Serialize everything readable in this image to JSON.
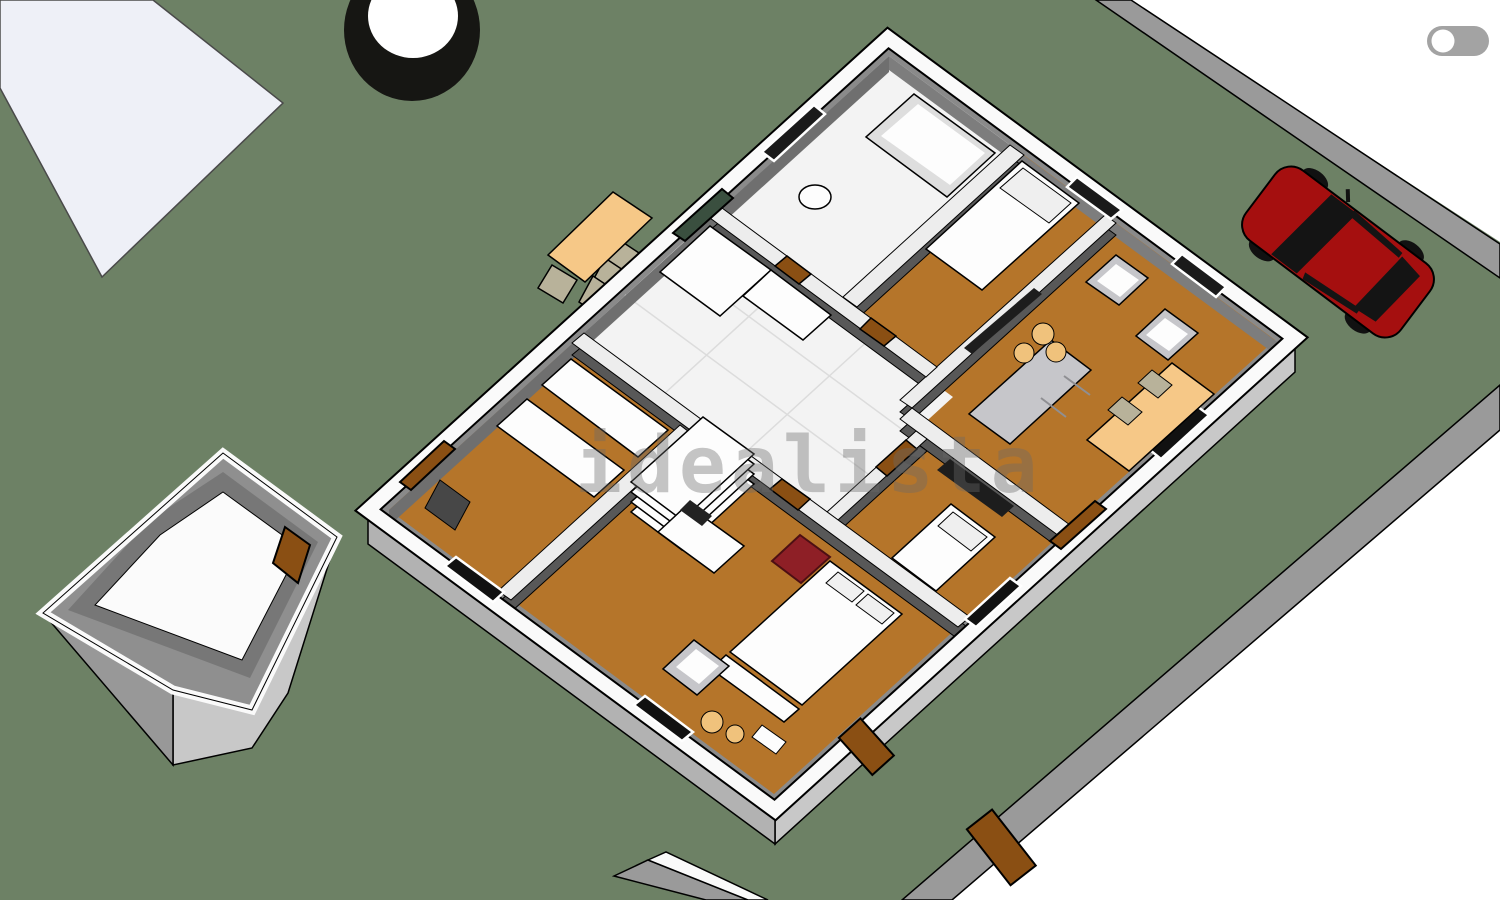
{
  "watermark": {
    "text": "idealista"
  },
  "toggle": {
    "state": "off",
    "label": "view-toggle"
  },
  "colors": {
    "grass": "#6d8165",
    "outside_white": "#ffffff",
    "patio_white": "#eef0f7",
    "perimeter_wall": "#9a9a9a",
    "ext_wall_top": "#fafafa",
    "ext_face_se": "#c8c8c8",
    "ext_face_sw": "#b2b2b2",
    "house_base": "#8a8a8a",
    "inner_face_nw": "#6f6f6f",
    "inner_face_ne": "#7d7d7d",
    "int_wall_top": "#ededed",
    "int_wall_face": "#585858",
    "wood_floor": "#b5752a",
    "tile_floor": "#f3f3f3",
    "tile_line": "#dcdcdc",
    "furniture_white": "#fdfdfd",
    "sofa_gray": "#c6c6ca",
    "dark_slab": "#1d1d1d",
    "table_tan": "#f6c887",
    "pouf_tan": "#f0c27c",
    "chair_tan": "#b8b29a",
    "car_red": "#a50f0f",
    "car_dark": "#141414",
    "door_brown": "#8a4f13",
    "glass_green": "#3a4f3f",
    "spa_black": "#161613",
    "spa_white": "#ffffff",
    "red_chair": "#8e1f26",
    "watermark_gray": "#6a6a6a",
    "toggle_bg": "#a3a3a3",
    "toggle_knob": "#ffffff",
    "outline": "#000000"
  },
  "scene": {
    "type": "3d-floorplan-render",
    "rooms": [
      {
        "name": "bathroom",
        "floor": "tile",
        "furniture": [
          "bathtub",
          "toilet"
        ]
      },
      {
        "name": "bedroom-1",
        "floor": "wood",
        "furniture": [
          "single-bed"
        ]
      },
      {
        "name": "living-room",
        "floor": "wood",
        "furniture": [
          "sofa",
          "armchair",
          "armchair",
          "tv",
          "dining-table",
          "poufs"
        ]
      },
      {
        "name": "kitchen-hall",
        "floor": "tile",
        "furniture": [
          "l-counter"
        ]
      },
      {
        "name": "bedroom-2",
        "floor": "wood",
        "furniture": [
          "single-bed",
          "wardrobe-tv"
        ]
      },
      {
        "name": "entry-room",
        "floor": "wood",
        "furniture": [
          "counter",
          "counter"
        ]
      },
      {
        "name": "master-bedroom",
        "floor": "wood",
        "furniture": [
          "double-bed",
          "red-armchair",
          "desk",
          "armchair",
          "poufs",
          "bench",
          "shelf-stack"
        ]
      }
    ],
    "exterior": [
      "grass-yard",
      "white-patio",
      "round-spa",
      "outdoor-dining-set",
      "red-car",
      "outbuilding",
      "perimeter-walls",
      "garden-doors"
    ]
  }
}
